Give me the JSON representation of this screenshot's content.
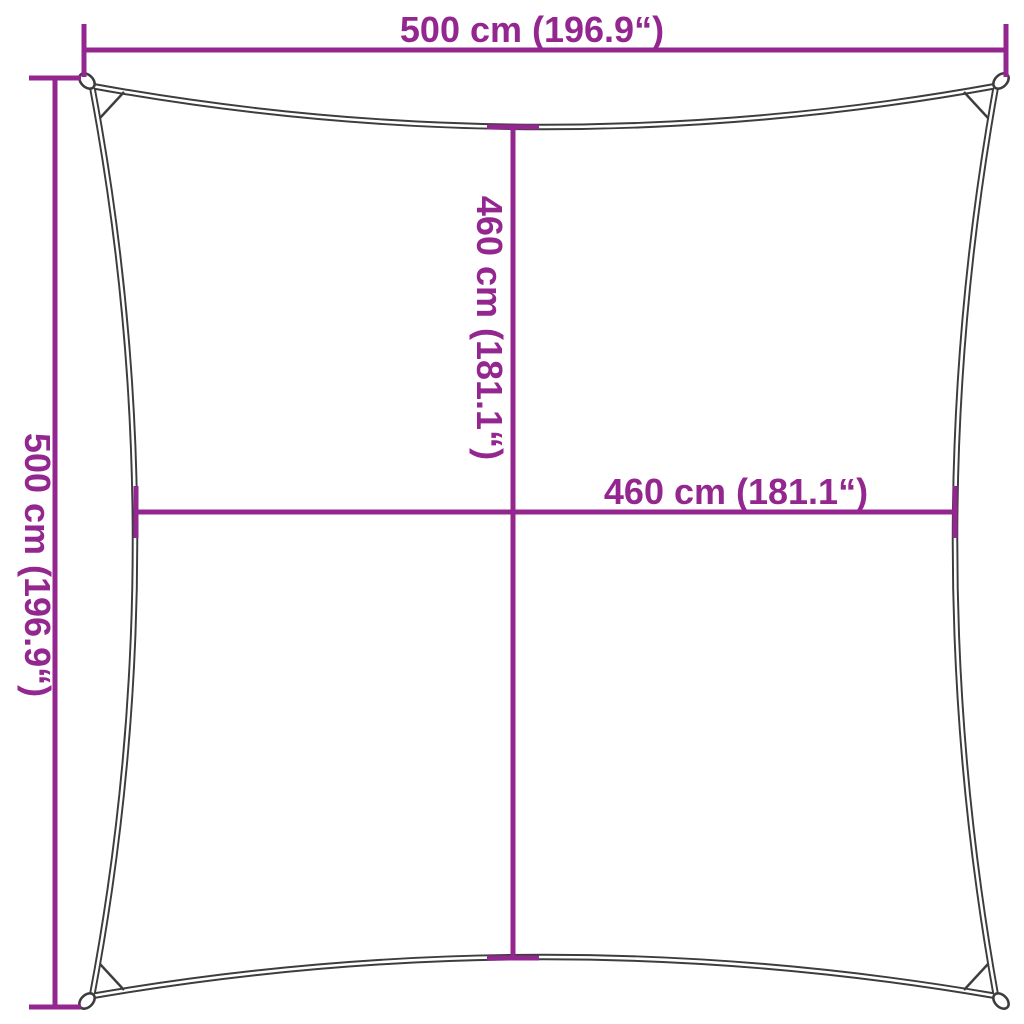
{
  "canvas": {
    "background": "#ffffff"
  },
  "colors": {
    "dimension_line": "#93278F",
    "sail_outline": "#3D3D3D"
  },
  "labels": {
    "outer_width": "500 cm (196.9“)",
    "outer_height": "500 cm (196.9“)",
    "inner_height": "460 cm (181.1“)",
    "inner_width": "460 cm (181.1“)"
  },
  "measurements": {
    "outer_width_cm": 500,
    "outer_width_inches": 196.9,
    "outer_height_cm": 500,
    "outer_height_inches": 196.9,
    "inner_height_cm": 460,
    "inner_height_inches": 181.1,
    "inner_width_cm": 460,
    "inner_width_inches": 181.1
  }
}
